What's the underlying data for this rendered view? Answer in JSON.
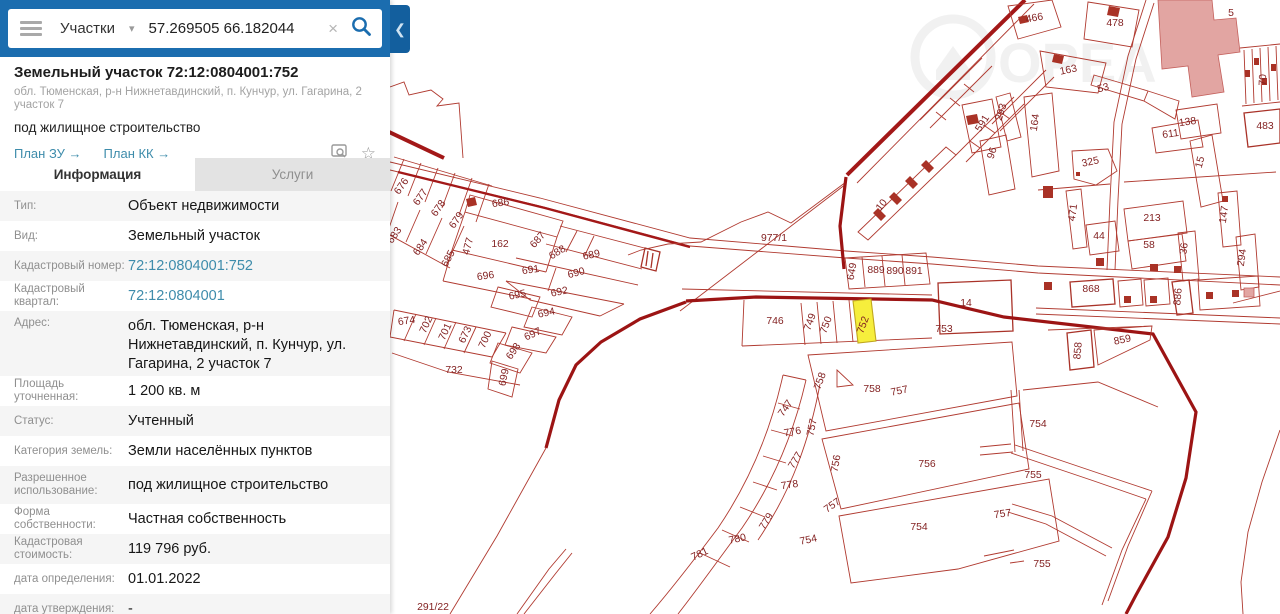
{
  "header": {
    "category": "Участки",
    "search_value": "57.269505 66.182044",
    "clear_icon": "close-x",
    "search_icon": "magnifier",
    "menu_icon": "hamburger",
    "collapse_icon": "chevron-left"
  },
  "panel": {
    "title": "Земельный участок 72:12:0804001:752",
    "subtitle": "обл. Тюменская, р-н Нижнетавдинский, п. Кунчур, ул. Гагарина, 2 участок 7",
    "usage": "под жилищное строительство",
    "link_zu": "План ЗУ →",
    "link_kk": "План КК →",
    "preview_icon": "doc-magnifier",
    "favorite_icon": "star",
    "star_glyph": "☆"
  },
  "tabs": {
    "info": "Информация",
    "services": "Услуги"
  },
  "info_rows": [
    {
      "label": "Тип:",
      "value": "Объект недвижимости"
    },
    {
      "label": "Вид:",
      "value": "Земельный участок"
    },
    {
      "label": "Кадастровый номер:",
      "value": "72:12:0804001:752",
      "link": true
    },
    {
      "label": "Кадастровый квартал:",
      "value": "72:12:0804001",
      "link": true
    },
    {
      "label": "Адрес:",
      "value": "обл. Тюменская, р-н Нижнетавдинский, п. Кунчур, ул. Гагарина, 2 участок 7",
      "tall": true
    },
    {
      "label": "Площадь уточненная:",
      "value": "1 200 кв. м"
    },
    {
      "label": "Статус:",
      "value": "Учтенный"
    },
    {
      "label": "Категория земель:",
      "value": "Земли населённых пунктов"
    },
    {
      "label": "Разрешенное использование:",
      "value": "под жилищное строительство",
      "mid": true
    },
    {
      "label": "Форма собственности:",
      "value": "Частная собственность"
    },
    {
      "label": "Кадастровая стоимость:",
      "value": "119 796 руб."
    },
    {
      "label": "дата определения:",
      "value": "01.01.2022"
    },
    {
      "label": "дата утверждения:",
      "value": "-"
    }
  ],
  "map": {
    "highlighted_parcel": "752",
    "watermark": "ОРЕА",
    "labels": [
      {
        "t": "676",
        "x": 404,
        "y": 188,
        "r": -55
      },
      {
        "t": "677",
        "x": 423,
        "y": 199,
        "r": -55
      },
      {
        "t": "678",
        "x": 441,
        "y": 210,
        "r": -55
      },
      {
        "t": "679",
        "x": 459,
        "y": 222,
        "r": -55
      },
      {
        "t": "477",
        "x": 471,
        "y": 247,
        "r": -75
      },
      {
        "t": "686",
        "x": 501,
        "y": 206,
        "r": -8
      },
      {
        "t": "683",
        "x": 397,
        "y": 237,
        "r": -55
      },
      {
        "t": "684",
        "x": 423,
        "y": 249,
        "r": -55
      },
      {
        "t": "685",
        "x": 451,
        "y": 260,
        "r": -62
      },
      {
        "t": "162",
        "x": 500,
        "y": 247,
        "r": 0
      },
      {
        "t": "687",
        "x": 540,
        "y": 242,
        "r": -48
      },
      {
        "t": "688",
        "x": 559,
        "y": 255,
        "r": -32
      },
      {
        "t": "689",
        "x": 592,
        "y": 258,
        "r": -12
      },
      {
        "t": "691",
        "x": 531,
        "y": 273,
        "r": -8
      },
      {
        "t": "690",
        "x": 577,
        "y": 276,
        "r": -15
      },
      {
        "t": "692",
        "x": 560,
        "y": 295,
        "r": -12
      },
      {
        "t": "696",
        "x": 486,
        "y": 279,
        "r": -8
      },
      {
        "t": "695",
        "x": 518,
        "y": 298,
        "r": -12
      },
      {
        "t": "694",
        "x": 547,
        "y": 316,
        "r": -12
      },
      {
        "t": "697",
        "x": 534,
        "y": 337,
        "r": -25
      },
      {
        "t": "698",
        "x": 516,
        "y": 353,
        "r": -55
      },
      {
        "t": "699",
        "x": 507,
        "y": 378,
        "r": -78
      },
      {
        "t": "674",
        "x": 407,
        "y": 324,
        "r": -8
      },
      {
        "t": "702",
        "x": 429,
        "y": 326,
        "r": -65
      },
      {
        "t": "701",
        "x": 448,
        "y": 333,
        "r": -65
      },
      {
        "t": "673",
        "x": 468,
        "y": 336,
        "r": -65
      },
      {
        "t": "700",
        "x": 488,
        "y": 341,
        "r": -65
      },
      {
        "t": "732",
        "x": 454,
        "y": 373,
        "r": 0
      },
      {
        "t": "291/22",
        "x": 433,
        "y": 610,
        "r": 0
      },
      {
        "t": "977/1",
        "x": 774,
        "y": 241,
        "r": 0
      },
      {
        "t": "10",
        "x": 884,
        "y": 207,
        "r": -52
      },
      {
        "t": "649",
        "x": 855,
        "y": 272,
        "r": -80
      },
      {
        "t": "889",
        "x": 876,
        "y": 273,
        "r": 0
      },
      {
        "t": "890",
        "x": 895,
        "y": 274,
        "r": 0
      },
      {
        "t": "891",
        "x": 914,
        "y": 274,
        "r": 0
      },
      {
        "t": "14",
        "x": 966,
        "y": 306,
        "r": 0
      },
      {
        "t": "753",
        "x": 944,
        "y": 332,
        "r": 0
      },
      {
        "t": "746",
        "x": 775,
        "y": 324,
        "r": 0
      },
      {
        "t": "749",
        "x": 813,
        "y": 323,
        "r": -70
      },
      {
        "t": "750",
        "x": 829,
        "y": 326,
        "r": -70
      },
      {
        "t": "752",
        "x": 866,
        "y": 326,
        "r": -70
      },
      {
        "t": "858",
        "x": 1081,
        "y": 351,
        "r": -85
      },
      {
        "t": "859",
        "x": 1123,
        "y": 343,
        "r": -12
      },
      {
        "t": "868",
        "x": 1091,
        "y": 292,
        "r": 0
      },
      {
        "t": "886",
        "x": 1181,
        "y": 297,
        "r": -85
      },
      {
        "t": "466",
        "x": 1035,
        "y": 21,
        "r": -10
      },
      {
        "t": "478",
        "x": 1115,
        "y": 26,
        "r": 0
      },
      {
        "t": "5",
        "x": 1231,
        "y": 16,
        "r": 0
      },
      {
        "t": "163",
        "x": 1069,
        "y": 73,
        "r": -12
      },
      {
        "t": "53",
        "x": 1104,
        "y": 91,
        "r": -15
      },
      {
        "t": "293",
        "x": 1004,
        "y": 113,
        "r": -72
      },
      {
        "t": "591",
        "x": 985,
        "y": 125,
        "r": -58
      },
      {
        "t": "96",
        "x": 995,
        "y": 154,
        "r": -72
      },
      {
        "t": "164",
        "x": 1038,
        "y": 123,
        "r": -82
      },
      {
        "t": "325",
        "x": 1091,
        "y": 165,
        "r": -12
      },
      {
        "t": "138",
        "x": 1188,
        "y": 125,
        "r": -8
      },
      {
        "t": "611",
        "x": 1171,
        "y": 137,
        "r": -8
      },
      {
        "t": "15",
        "x": 1203,
        "y": 163,
        "r": -75
      },
      {
        "t": "70",
        "x": 1266,
        "y": 80,
        "r": -88
      },
      {
        "t": "483",
        "x": 1265,
        "y": 129,
        "r": 0
      },
      {
        "t": "471",
        "x": 1076,
        "y": 213,
        "r": -82
      },
      {
        "t": "44",
        "x": 1099,
        "y": 239,
        "r": 0
      },
      {
        "t": "213",
        "x": 1152,
        "y": 221,
        "r": 0
      },
      {
        "t": "58",
        "x": 1149,
        "y": 248,
        "r": 0
      },
      {
        "t": "36",
        "x": 1187,
        "y": 249,
        "r": -82
      },
      {
        "t": "147",
        "x": 1227,
        "y": 215,
        "r": -82
      },
      {
        "t": "294",
        "x": 1245,
        "y": 258,
        "r": -82
      },
      {
        "t": "747",
        "x": 788,
        "y": 410,
        "r": -55
      },
      {
        "t": "776",
        "x": 793,
        "y": 435,
        "r": -10
      },
      {
        "t": "757",
        "x": 815,
        "y": 428,
        "r": -78
      },
      {
        "t": "777",
        "x": 798,
        "y": 462,
        "r": -58
      },
      {
        "t": "778",
        "x": 790,
        "y": 488,
        "r": -8
      },
      {
        "t": "779",
        "x": 769,
        "y": 523,
        "r": -58
      },
      {
        "t": "780",
        "x": 738,
        "y": 542,
        "r": -12
      },
      {
        "t": "781",
        "x": 701,
        "y": 557,
        "r": -25
      },
      {
        "t": "758",
        "x": 823,
        "y": 382,
        "r": -70
      },
      {
        "t": "758",
        "x": 872,
        "y": 392,
        "r": 0
      },
      {
        "t": "757",
        "x": 900,
        "y": 394,
        "r": -12
      },
      {
        "t": "756",
        "x": 839,
        "y": 464,
        "r": -80
      },
      {
        "t": "756",
        "x": 927,
        "y": 467,
        "r": 0
      },
      {
        "t": "757",
        "x": 834,
        "y": 508,
        "r": -35
      },
      {
        "t": "754",
        "x": 809,
        "y": 543,
        "r": -12
      },
      {
        "t": "754",
        "x": 919,
        "y": 530,
        "r": 0
      },
      {
        "t": "757",
        "x": 1003,
        "y": 517,
        "r": -8
      },
      {
        "t": "754",
        "x": 1038,
        "y": 427,
        "r": 0
      },
      {
        "t": "755",
        "x": 1033,
        "y": 478,
        "r": 0
      },
      {
        "t": "755",
        "x": 1042,
        "y": 567,
        "r": 0
      }
    ]
  }
}
